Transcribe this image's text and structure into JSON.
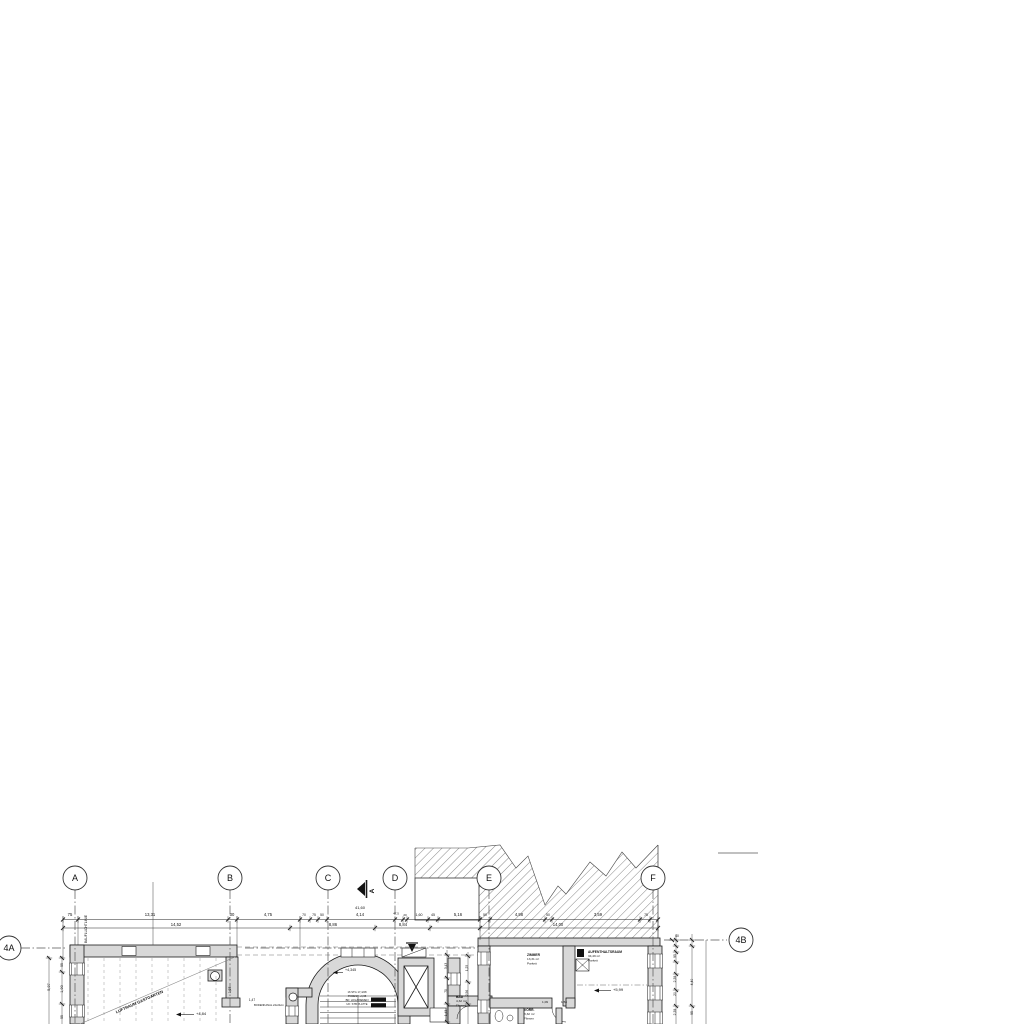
{
  "drawing": {
    "colors": {
      "line": "#1c1c1c",
      "wall_fill": "#d8d8d8",
      "grid_line": "#555555",
      "hatch": "#555555"
    },
    "grid": {
      "bubble_y": 878,
      "columns": [
        {
          "label": "A",
          "x": 75
        },
        {
          "label": "B",
          "x": 230
        },
        {
          "label": "C",
          "x": 328
        },
        {
          "label": "D",
          "x": 395
        },
        {
          "label": "E",
          "x": 489
        },
        {
          "label": "F",
          "x": 653
        }
      ],
      "rows": [
        {
          "label": "4A",
          "x": 9,
          "y": 948
        },
        {
          "label": "4B",
          "x": 741,
          "y": 940
        }
      ]
    },
    "rooms": [
      {
        "name": "ZIMMER",
        "area": "13,31 m²",
        "floor": "Parkett",
        "x": 527,
        "y": 956
      },
      {
        "name": "AUFENTHALTSRAUM",
        "area": "34,49 m²",
        "floor": "Parkett",
        "x": 588,
        "y": 953
      },
      {
        "name": "VORR.",
        "area": "3,32 m²",
        "floor": "Fliesen",
        "x": 524,
        "y": 1011
      },
      {
        "name": "BAD",
        "area": "4,32 m²",
        "floor": "Fliesen",
        "x": 456,
        "y": 998
      }
    ],
    "annotations": [
      {
        "t": "75",
        "x": 70,
        "y": 916
      },
      {
        "t": "13,31",
        "x": 150,
        "y": 916
      },
      {
        "t": "30",
        "x": 232,
        "y": 916
      },
      {
        "t": "4,75",
        "x": 268,
        "y": 916
      },
      {
        "t": "70",
        "x": 304,
        "y": 916,
        "fs": 3.4
      },
      {
        "t": "75",
        "x": 314,
        "y": 916,
        "fs": 3.4
      },
      {
        "t": "50",
        "x": 322,
        "y": 916,
        "fs": 3.4
      },
      {
        "t": "4,14",
        "x": 360,
        "y": 916
      },
      {
        "t": "47,5",
        "x": 396,
        "y": 914.5,
        "fs": 3.0
      },
      {
        "t": "20",
        "x": 405,
        "y": 916,
        "fs": 3.0
      },
      {
        "t": "1,60",
        "x": 419,
        "y": 916,
        "fs": 3.6
      },
      {
        "t": "45",
        "x": 433,
        "y": 916,
        "fs": 3.6
      },
      {
        "t": "5,16",
        "x": 458,
        "y": 916
      },
      {
        "t": "50",
        "x": 485,
        "y": 916,
        "fs": 3.4
      },
      {
        "t": "4,98",
        "x": 519,
        "y": 916
      },
      {
        "t": "50",
        "x": 548,
        "y": 916,
        "fs": 3.4
      },
      {
        "t": "3,59",
        "x": 598,
        "y": 916
      },
      {
        "t": "75",
        "x": 646,
        "y": 916,
        "fs": 3.4
      },
      {
        "t": "14,52",
        "x": 176,
        "y": 925.8
      },
      {
        "t": "8,86",
        "x": 333,
        "y": 925.8
      },
      {
        "t": "8,84",
        "x": 403,
        "y": 925.8
      },
      {
        "t": "14,00",
        "x": 558,
        "y": 925.8
      },
      {
        "t": "41,60",
        "x": 360,
        "y": 909,
        "fs": 4.0
      },
      {
        "t": "5,97",
        "x": 50,
        "y": 987,
        "r": -90,
        "fs": 3.8
      },
      {
        "t": "1,90",
        "x": 63,
        "y": 989,
        "r": -90,
        "fs": 3.8
      },
      {
        "t": "55",
        "x": 63,
        "y": 965,
        "r": -90,
        "fs": 3.4
      },
      {
        "t": "55",
        "x": 63,
        "y": 1017,
        "r": -90,
        "fs": 3.4
      },
      {
        "t": "BAUFLUCHTLINIE",
        "x": 87,
        "y": 929,
        "r": -90,
        "fs": 3.3
      },
      {
        "t": "1,97",
        "x": 231,
        "y": 990,
        "r": -90,
        "fs": 3.4
      },
      {
        "t": "1,47",
        "x": 252,
        "y": 1001,
        "fs": 3.2
      },
      {
        "t": "BODENKANAL 24x24cm",
        "x": 254,
        "y": 1006,
        "fs": 2.7,
        "an": "start"
      },
      {
        "t": "LUFTRAUM GASTGARTEN",
        "x": 140,
        "y": 1003,
        "r": -24,
        "fs": 4.0,
        "w": 700
      },
      {
        "t": "+4,84",
        "x": 196,
        "y": 1015,
        "fs": 4.0,
        "an": "start"
      },
      {
        "t": "+4,345",
        "x": 345,
        "y": 971,
        "fs": 3.6,
        "an": "start"
      },
      {
        "t": "16 STG 17,4/28",
        "x": 357,
        "y": 993,
        "fs": 2.7
      },
      {
        "t": "PODEST +4,35",
        "x": 357,
        "y": 997,
        "fs": 2.7
      },
      {
        "t": "BD: HOLZRIEMEN",
        "x": 357,
        "y": 1001,
        "fs": 2.7
      },
      {
        "t": "UK: STB PLATTE",
        "x": 357,
        "y": 1005,
        "fs": 2.7
      },
      {
        "t": "+5,99",
        "x": 613,
        "y": 991,
        "fs": 4.0,
        "an": "start"
      },
      {
        "t": "1,09",
        "x": 545,
        "y": 1003,
        "fs": 3.1
      },
      {
        "t": "1,54",
        "x": 564,
        "y": 1003,
        "fs": 3.1
      },
      {
        "t": "3,43",
        "x": 447,
        "y": 966,
        "r": -90,
        "fs": 3.2
      },
      {
        "t": "70",
        "x": 447,
        "y": 991,
        "r": -90,
        "fs": 3.2
      },
      {
        "t": "1,43",
        "x": 447,
        "y": 1013,
        "r": -90,
        "fs": 3.2
      },
      {
        "t": "1,25",
        "x": 468,
        "y": 968,
        "r": -90,
        "fs": 3.2
      },
      {
        "t": "2,56",
        "x": 468,
        "y": 993,
        "r": -90,
        "fs": 3.2
      },
      {
        "t": "40",
        "x": 677,
        "y": 937,
        "fs": 3.4
      },
      {
        "t": "95",
        "x": 676,
        "y": 956,
        "r": -90,
        "fs": 3.4
      },
      {
        "t": "2,39",
        "x": 676,
        "y": 979,
        "r": -90,
        "fs": 3.4
      },
      {
        "t": "20",
        "x": 676,
        "y": 994,
        "r": -90,
        "fs": 3.4
      },
      {
        "t": "2,39",
        "x": 676,
        "y": 1012,
        "r": -90,
        "fs": 3.4
      },
      {
        "t": "4,40",
        "x": 693,
        "y": 982,
        "r": -90,
        "fs": 3.4
      },
      {
        "t": "95",
        "x": 693,
        "y": 1013,
        "r": -90,
        "fs": 3.4
      },
      {
        "t": "A",
        "x": 374,
        "y": 891,
        "r": -90,
        "fs": 6.5,
        "w": 700,
        "dn": "section-marker-letter"
      }
    ]
  }
}
